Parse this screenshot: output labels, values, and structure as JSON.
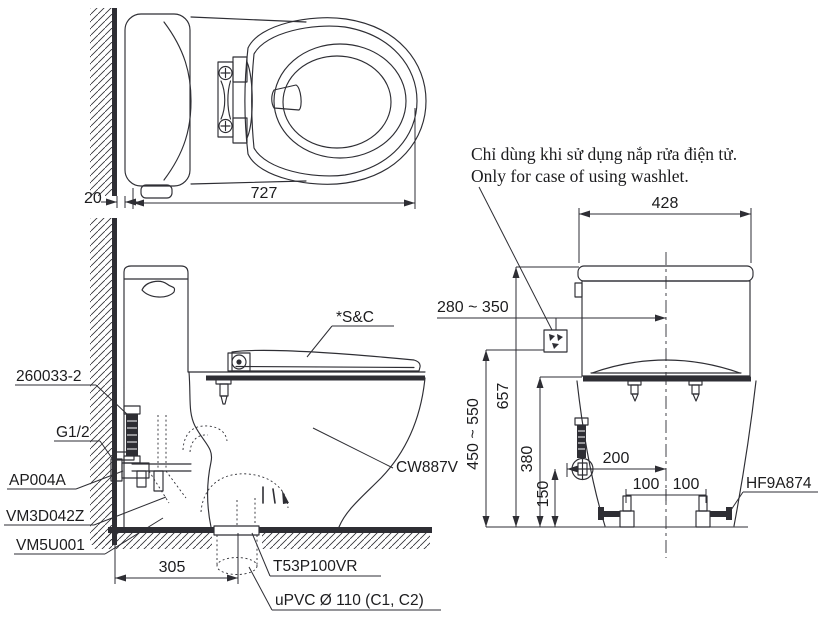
{
  "colors": {
    "line": "#2e2e34",
    "text": "#1c1c1e",
    "bg": "#ffffff"
  },
  "note": {
    "line1": "Chỉ dùng khi sử dụng nắp rửa điện tử.",
    "line2": "Only for case of using washlet."
  },
  "top_view": {
    "dim_depth": "727",
    "dim_wall_gap": "20"
  },
  "side_view": {
    "label_supply_hose": "260033-2",
    "label_thread": "G1/2",
    "label_stop_valve": "AP004A",
    "label_seal": "VM3D042Z",
    "label_flange": "VM5U001",
    "label_seat": "*S&C",
    "label_model": "CW887V",
    "label_drain_joint": "T53P100VR",
    "label_drain_pipe": "uPVC Ø 110 (C1, C2)",
    "dim_rough_in": "305"
  },
  "rear_view": {
    "label_bolt": "HF9A874",
    "dim_tank_width": "428",
    "dim_supply_offset_range": "280 ~ 350",
    "dim_outlet_height_range": "450 ~ 550",
    "dim_total_height": "657",
    "dim_rim_height": "380",
    "dim_supply_height": "150",
    "dim_supply_offset": "200",
    "dim_bolt_left": "100",
    "dim_bolt_right": "100"
  }
}
